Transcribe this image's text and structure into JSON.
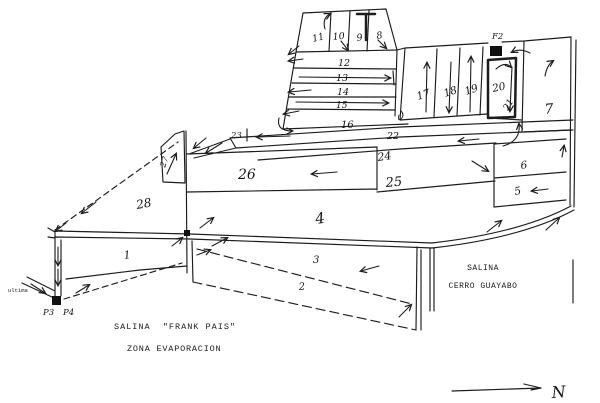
{
  "figure": {
    "kind": "hand-drawn map of salt evaporation ponds",
    "ink_color": "#1c1c1c",
    "paper_color": "#ffffff"
  },
  "ponds": {
    "1": "1",
    "2": "2",
    "3": "3",
    "4": "4",
    "5": "5",
    "6": "6",
    "7": "7",
    "8": "8",
    "9": "9",
    "10": "10",
    "11": "11",
    "12": "12",
    "13": "13",
    "14": "14",
    "15": "15",
    "16": "16",
    "17": "17",
    "18": "18",
    "19": "19",
    "20": "20",
    "21": "21",
    "22": "22",
    "23": "23",
    "24": "24",
    "25": "25",
    "26": "26",
    "27": "27",
    "28": "28"
  },
  "labels": {
    "f2": "F2",
    "pump_p3": "P3",
    "pump_p4": "P4",
    "intake_note": "ultima",
    "north": "N",
    "site_name": "SALINA  \"FRANK PAIS\"",
    "zone_name": "ZONA EVAPORACION",
    "neighbor_name_line1": "SALINA",
    "neighbor_name_line2": "CERRO GUAYABO"
  }
}
